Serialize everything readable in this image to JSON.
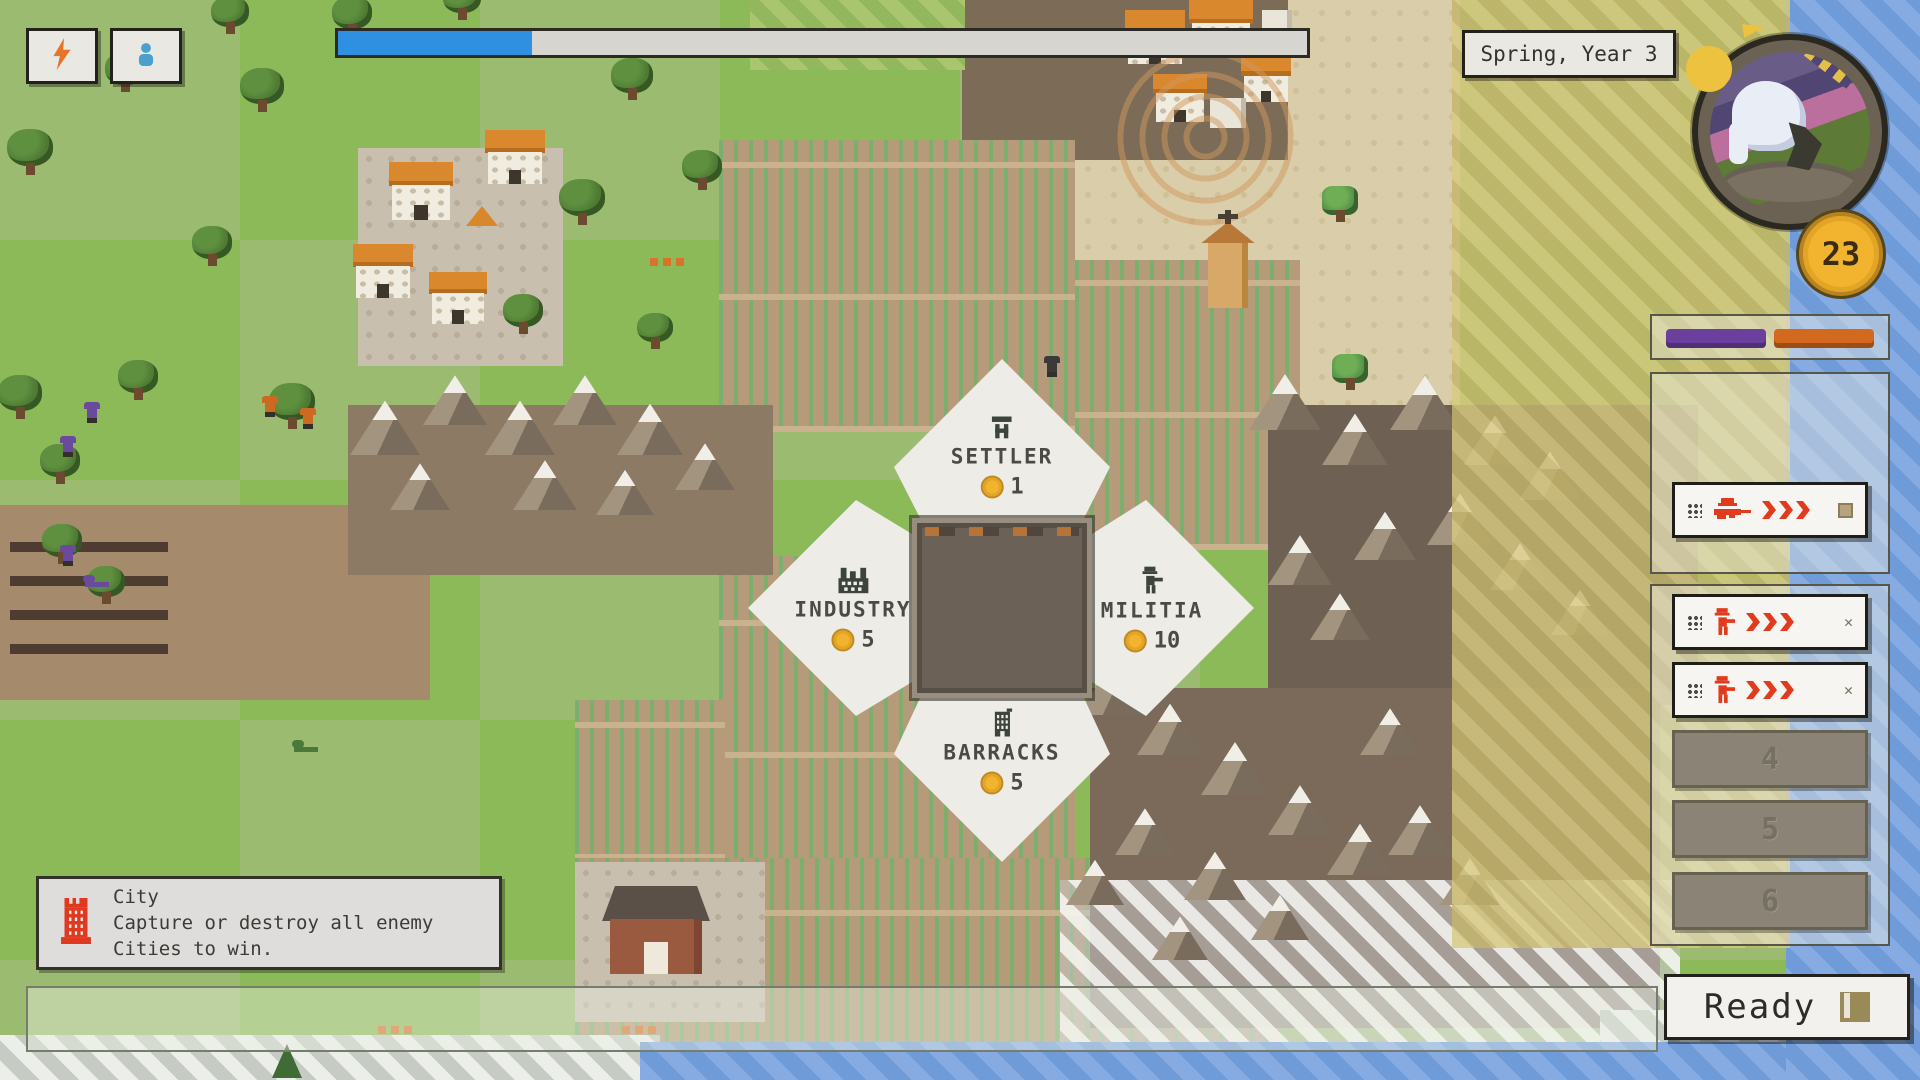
{
  "hud": {
    "season_label": "Spring, Year 3",
    "coins": "23",
    "ready_label": "Ready",
    "progress_percent": 20,
    "buttons": [
      {
        "icon": "lightning-icon"
      },
      {
        "icon": "person-icon"
      }
    ]
  },
  "build_menu": {
    "options": [
      {
        "id": "settler",
        "label": "SETTLER",
        "cost": "1",
        "icon": "settler-flag-icon"
      },
      {
        "id": "industry",
        "label": "INDUSTRY",
        "cost": "5",
        "icon": "factory-icon"
      },
      {
        "id": "militia",
        "label": "MILITIA",
        "cost": "10",
        "icon": "soldier-icon"
      },
      {
        "id": "barracks",
        "label": "BARRACKS",
        "cost": "5",
        "icon": "barracks-building-icon"
      }
    ]
  },
  "production": {
    "bars": [
      {
        "color": "#6a3f9e",
        "x": 1664,
        "w": 100
      },
      {
        "color": "#d2691e",
        "x": 1772,
        "w": 100
      }
    ],
    "queue_items": [
      {
        "y": 482,
        "icon": "sniper",
        "action": "square"
      },
      {
        "y": 594,
        "icon": "soldier",
        "action": "close"
      },
      {
        "y": 662,
        "icon": "soldier",
        "action": "close"
      }
    ],
    "empty_slots": [
      {
        "y": 730,
        "label": "4"
      },
      {
        "y": 800,
        "label": "5"
      },
      {
        "y": 872,
        "label": "6"
      }
    ],
    "close_glyph": "✕"
  },
  "tooltip": {
    "title": "City",
    "line1": "Capture or destroy all enemy",
    "line2": "Cities to win."
  },
  "colors": {
    "progress_blue": "#2f8fe0",
    "accent_red": "#e23a1c",
    "coin_gold": "#f2b42e",
    "bar_purple": "#6a3f9e",
    "bar_orange": "#d2691e"
  },
  "map": {
    "regions": [
      {
        "cls": "r-dirt",
        "x": 0,
        "y": 505,
        "w": 430,
        "h": 195
      },
      {
        "cls": "r-trench",
        "x": 10,
        "y": 518,
        "w": 158,
        "h": 152
      },
      {
        "cls": "r-cobble",
        "x": 358,
        "y": 148,
        "w": 205,
        "h": 218
      },
      {
        "cls": "r-sand",
        "x": 1075,
        "y": 0,
        "w": 385,
        "h": 415
      },
      {
        "cls": "r-darksoil",
        "x": 962,
        "y": 0,
        "w": 326,
        "h": 160
      },
      {
        "cls": "r-greenhatch",
        "x": 750,
        "y": 0,
        "w": 215,
        "h": 70
      },
      {
        "cls": "r-farm",
        "x": 719,
        "y": 140,
        "w": 356,
        "h": 292
      },
      {
        "cls": "r-farm",
        "x": 719,
        "y": 556,
        "w": 356,
        "h": 334
      },
      {
        "cls": "r-farm",
        "x": 1075,
        "y": 260,
        "w": 225,
        "h": 290
      },
      {
        "cls": "r-farm",
        "x": 575,
        "y": 700,
        "w": 150,
        "h": 160
      },
      {
        "cls": "r-farm",
        "x": 575,
        "y": 858,
        "w": 705,
        "h": 190
      },
      {
        "cls": "r-cobble",
        "x": 575,
        "y": 862,
        "w": 190,
        "h": 160
      },
      {
        "cls": "r-mbgA",
        "x": 348,
        "y": 405,
        "w": 425,
        "h": 170
      },
      {
        "cls": "r-mbgB",
        "x": 1268,
        "y": 405,
        "w": 430,
        "h": 300
      },
      {
        "cls": "r-mbgC",
        "x": 1090,
        "y": 688,
        "w": 570,
        "h": 340
      },
      {
        "cls": "r-snow",
        "x": 1060,
        "y": 880,
        "w": 620,
        "h": 190
      },
      {
        "cls": "r-ice",
        "x": 0,
        "y": 1035,
        "w": 660,
        "h": 45
      },
      {
        "cls": "r-ice",
        "x": 1600,
        "y": 1010,
        "w": 200,
        "h": 70
      },
      {
        "cls": "r-water",
        "x": 640,
        "y": 1042,
        "w": 1160,
        "h": 38
      },
      {
        "cls": "r-water",
        "x": 1786,
        "y": 0,
        "w": 134,
        "h": 1080
      }
    ],
    "tint": [
      {
        "cls": "r-yellow",
        "x": 1452,
        "y": 0,
        "w": 338,
        "h": 948
      }
    ],
    "trees": [
      {
        "x": 30,
        "y": 170,
        "s": 46
      },
      {
        "x": 125,
        "y": 88,
        "s": 40
      },
      {
        "x": 262,
        "y": 108,
        "s": 44
      },
      {
        "x": 352,
        "y": 32,
        "s": 40
      },
      {
        "x": 462,
        "y": 16,
        "s": 38
      },
      {
        "x": 582,
        "y": 220,
        "s": 46
      },
      {
        "x": 632,
        "y": 96,
        "s": 42
      },
      {
        "x": 702,
        "y": 186,
        "s": 40
      },
      {
        "x": 20,
        "y": 415,
        "s": 44
      },
      {
        "x": 138,
        "y": 396,
        "s": 40
      },
      {
        "x": 292,
        "y": 424,
        "s": 46
      },
      {
        "x": 62,
        "y": 560,
        "s": 40
      },
      {
        "x": 106,
        "y": 600,
        "s": 38
      },
      {
        "x": 212,
        "y": 262,
        "s": 40
      },
      {
        "x": 523,
        "y": 330,
        "s": 40
      },
      {
        "x": 60,
        "y": 480,
        "s": 40
      },
      {
        "x": 655,
        "y": 345,
        "s": 36
      },
      {
        "x": 230,
        "y": 30,
        "s": 38
      },
      {
        "x": 1340,
        "y": 218,
        "s": 36,
        "palm": true
      },
      {
        "x": 1350,
        "y": 386,
        "s": 36,
        "palm": true
      }
    ],
    "mountains": [
      {
        "x": 385,
        "y": 455,
        "s": 70
      },
      {
        "x": 455,
        "y": 425,
        "s": 64
      },
      {
        "x": 520,
        "y": 455,
        "s": 70
      },
      {
        "x": 585,
        "y": 425,
        "s": 64
      },
      {
        "x": 650,
        "y": 455,
        "s": 66
      },
      {
        "x": 705,
        "y": 490,
        "s": 60
      },
      {
        "x": 420,
        "y": 510,
        "s": 60
      },
      {
        "x": 545,
        "y": 510,
        "s": 64
      },
      {
        "x": 625,
        "y": 515,
        "s": 58
      },
      {
        "x": 1285,
        "y": 430,
        "s": 72
      },
      {
        "x": 1355,
        "y": 465,
        "s": 66
      },
      {
        "x": 1425,
        "y": 430,
        "s": 70
      },
      {
        "x": 1495,
        "y": 465,
        "s": 64
      },
      {
        "x": 1550,
        "y": 500,
        "s": 62
      },
      {
        "x": 1460,
        "y": 545,
        "s": 66
      },
      {
        "x": 1385,
        "y": 560,
        "s": 62
      },
      {
        "x": 1300,
        "y": 585,
        "s": 64
      },
      {
        "x": 1520,
        "y": 590,
        "s": 60
      },
      {
        "x": 1580,
        "y": 635,
        "s": 58
      },
      {
        "x": 1340,
        "y": 640,
        "s": 60
      },
      {
        "x": 1110,
        "y": 715,
        "s": 64
      },
      {
        "x": 1170,
        "y": 755,
        "s": 66
      },
      {
        "x": 1235,
        "y": 795,
        "s": 68
      },
      {
        "x": 1300,
        "y": 835,
        "s": 64
      },
      {
        "x": 1360,
        "y": 875,
        "s": 66
      },
      {
        "x": 1145,
        "y": 855,
        "s": 60
      },
      {
        "x": 1095,
        "y": 905,
        "s": 58
      },
      {
        "x": 1215,
        "y": 900,
        "s": 62
      },
      {
        "x": 1420,
        "y": 855,
        "s": 64
      },
      {
        "x": 1390,
        "y": 755,
        "s": 60
      },
      {
        "x": 1470,
        "y": 905,
        "s": 60
      },
      {
        "x": 1280,
        "y": 940,
        "s": 58
      },
      {
        "x": 1180,
        "y": 960,
        "s": 56
      }
    ],
    "houses": [
      {
        "x": 392,
        "y": 162,
        "s": 58
      },
      {
        "x": 356,
        "y": 244,
        "s": 54
      },
      {
        "x": 432,
        "y": 272,
        "s": 52
      },
      {
        "x": 488,
        "y": 130,
        "s": 54
      },
      {
        "x": 1128,
        "y": 10,
        "s": 54
      },
      {
        "x": 1192,
        "y": 0,
        "s": 58
      },
      {
        "x": 1156,
        "y": 74,
        "s": 48
      },
      {
        "x": 1244,
        "y": 58,
        "s": 44
      }
    ],
    "ruins": [
      {
        "x": 1210,
        "y": 98,
        "w": 36,
        "h": 30
      },
      {
        "x": 1262,
        "y": 10,
        "w": 30,
        "h": 26
      }
    ],
    "units": [
      {
        "x": 84,
        "y": 402,
        "c": "#6a4a9a"
      },
      {
        "x": 60,
        "y": 436,
        "c": "#6a4a9a"
      },
      {
        "x": 60,
        "y": 545,
        "c": "#6a4a9a"
      },
      {
        "x": 262,
        "y": 396,
        "c": "#cc6a22"
      },
      {
        "x": 300,
        "y": 408,
        "c": "#cc6a22"
      },
      {
        "x": 83,
        "y": 575,
        "c": "#6a4a9a",
        "prone": true
      },
      {
        "x": 292,
        "y": 740,
        "c": "#4a7a3a",
        "prone": true
      },
      {
        "x": 1044,
        "y": 356,
        "c": "#3a3a3a"
      }
    ],
    "extras": [
      {
        "t": "rings",
        "x": 1108,
        "y": 40,
        "s": 195
      },
      {
        "t": "dash",
        "x": 650,
        "y": 258
      },
      {
        "t": "dash",
        "x": 378,
        "y": 1026
      },
      {
        "t": "dash",
        "x": 622,
        "y": 1026
      },
      {
        "t": "tent",
        "x": 466,
        "y": 206
      },
      {
        "t": "barn",
        "x": 606,
        "y": 886
      },
      {
        "t": "church",
        "x": 1196,
        "y": 210
      },
      {
        "t": "pine",
        "x": 272,
        "y": 1044
      }
    ]
  }
}
